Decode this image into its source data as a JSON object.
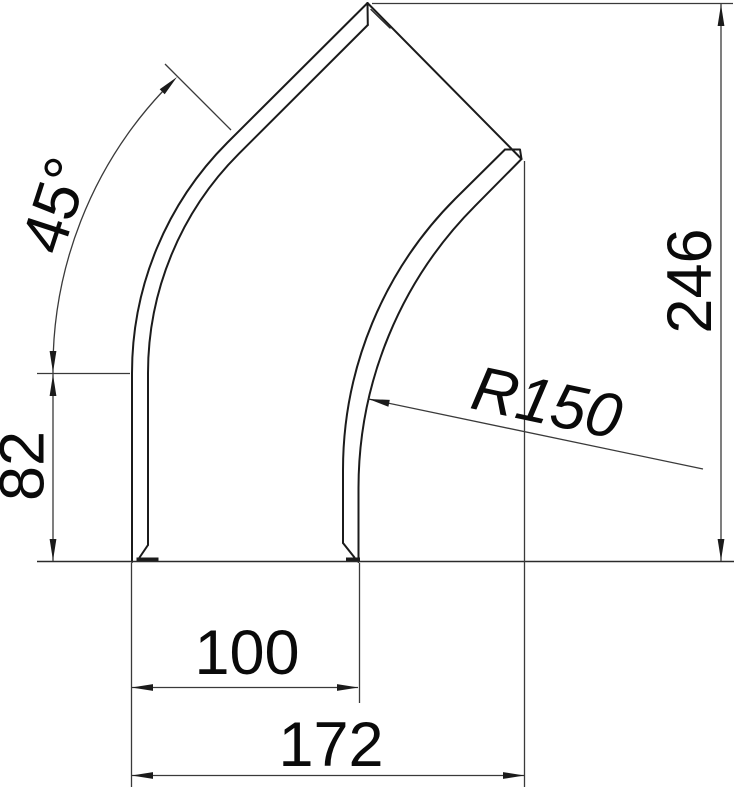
{
  "drawing": {
    "labels": {
      "angle": "45°",
      "side_height": "82",
      "overall_height": "246",
      "radius": "R150",
      "width": "100",
      "overall_width": "172"
    }
  }
}
